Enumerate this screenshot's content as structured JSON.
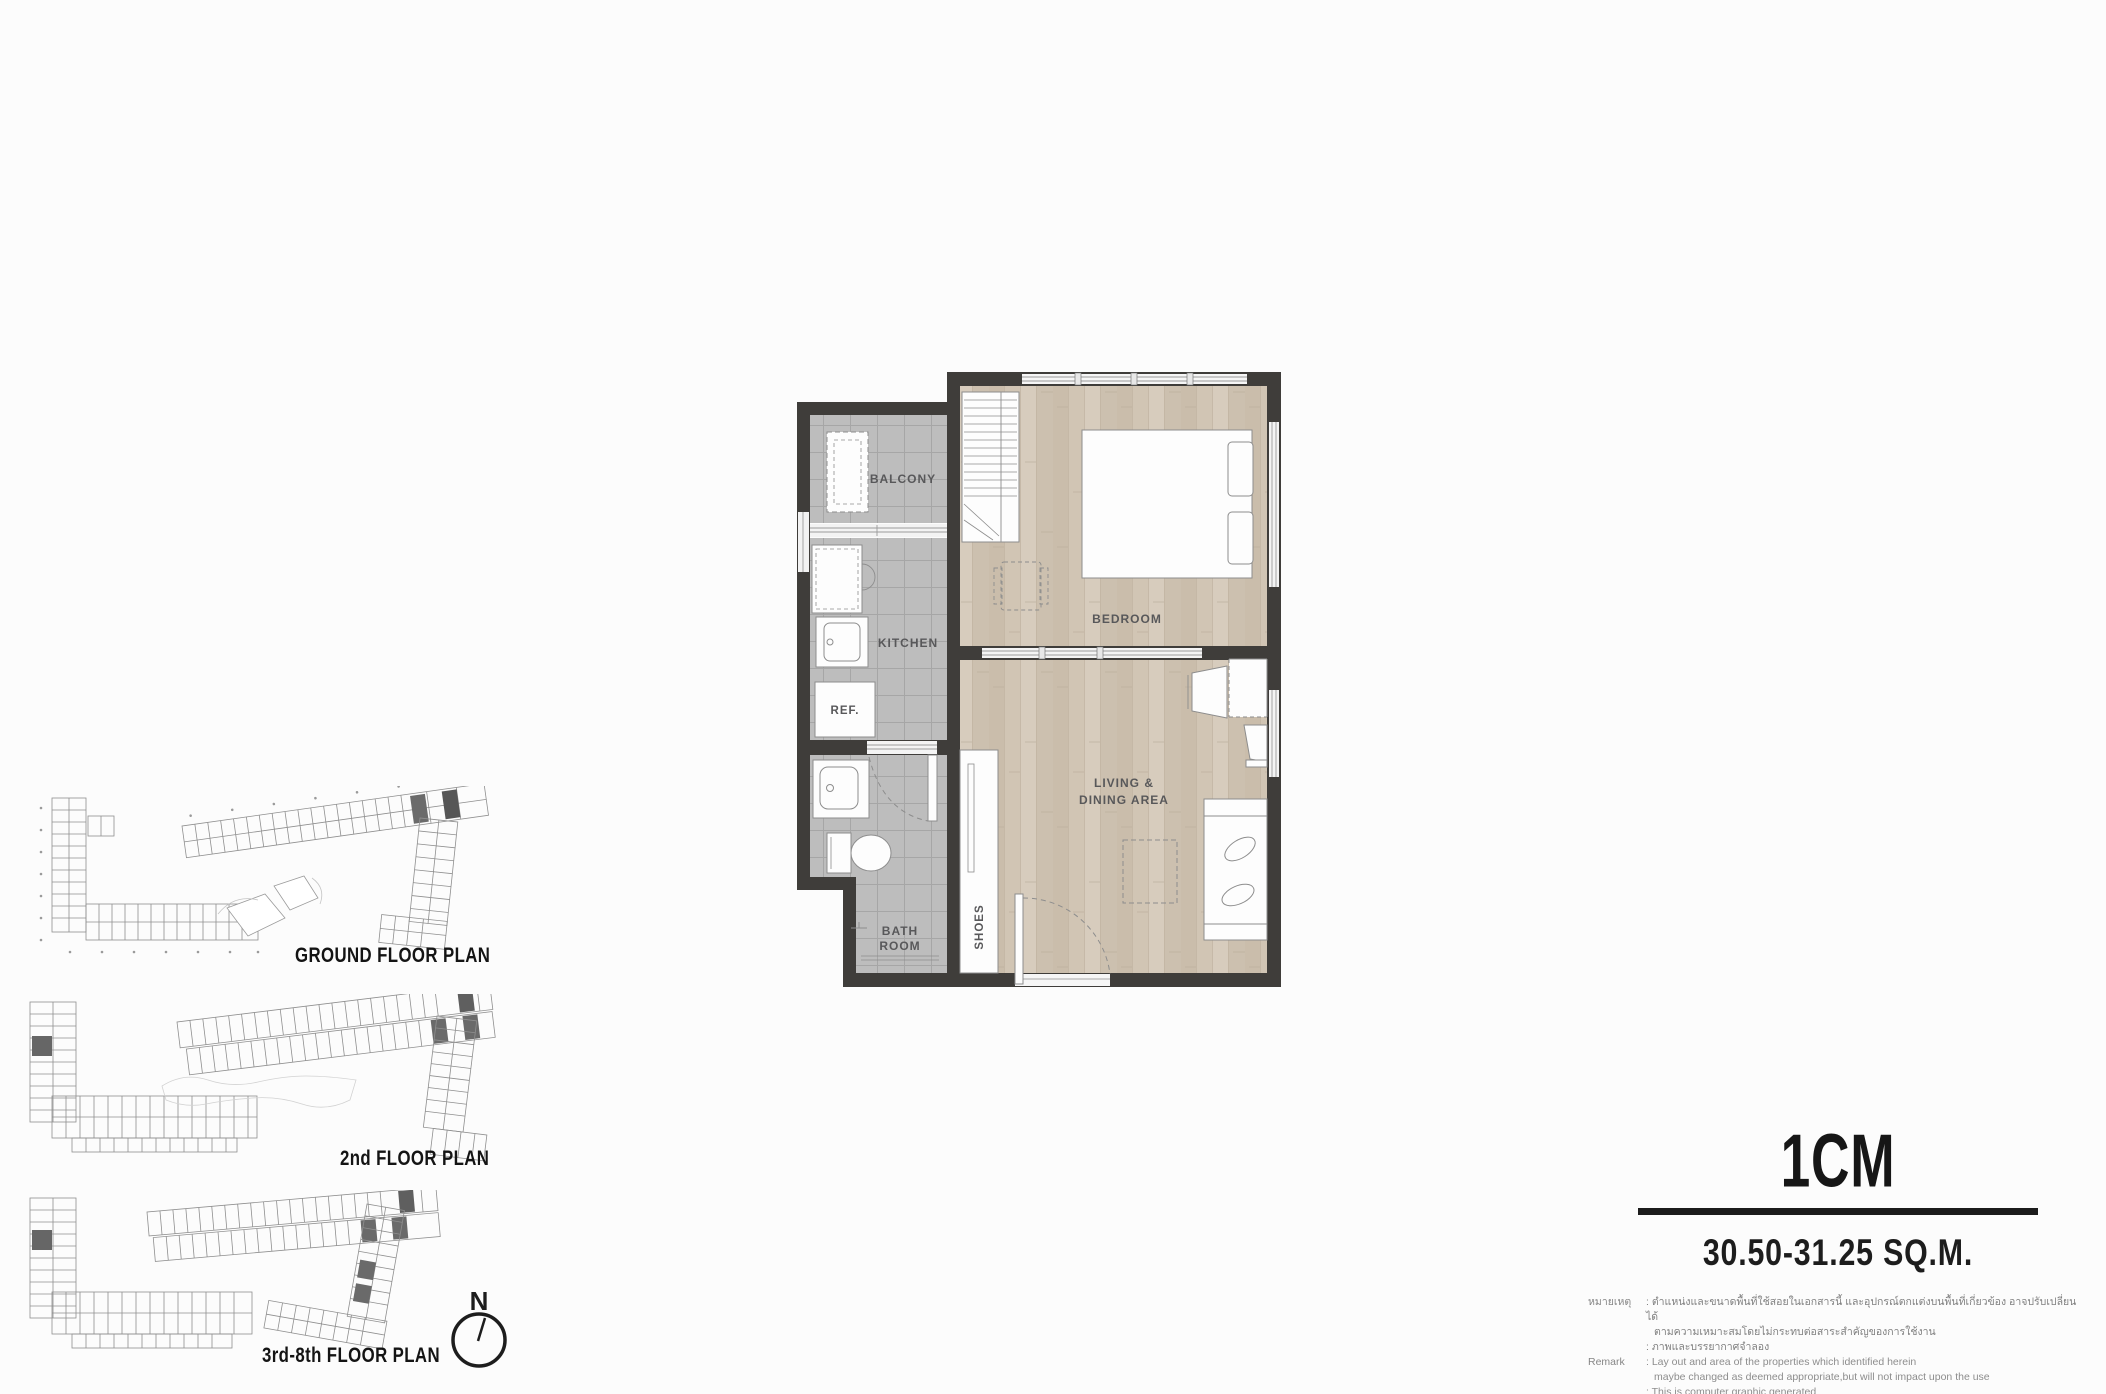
{
  "unit": {
    "code": "1CM",
    "area": "30.50-31.25  SQ.M."
  },
  "main_plan": {
    "labels": {
      "balcony": "BALCONY",
      "kitchen": "KITCHEN",
      "ref": "REF.",
      "bath_line1": "BATH",
      "bath_line2": "ROOM",
      "shoes": "SHOES",
      "bedroom": "BEDROOM",
      "living_line1": "LIVING &",
      "living_line2": "DINING AREA"
    }
  },
  "floor_plans": [
    {
      "label": "GROUND  FLOOR PLAN"
    },
    {
      "label": "2nd  FLOOR PLAN"
    },
    {
      "label": "3rd-8th  FLOOR PLAN"
    }
  ],
  "compass": {
    "label": "N"
  },
  "remarks": {
    "thai_label": "หมายเหตุ",
    "thai_line1": ": ตำแหน่งและขนาดพื้นที่ใช้สอยในเอกสารนี้ และอุปกรณ์ตกแต่งบนพื้นที่เกี่ยวข้อง อาจปรับเปลี่ยนได้",
    "thai_line2": "ตามความเหมาะสมโดยไม่กระทบต่อสาระสำคัญของการใช้งาน",
    "thai_line3": ": ภาพและบรรยากาศจำลอง",
    "en_label": "Remark",
    "en_line1": ": Lay out and area of the properties which identified herein",
    "en_line2": "maybe changed as deemed appropriate,but will not impact upon the use",
    "en_line3": ": This is computer graphic generated"
  },
  "colors": {
    "wall": "#3f3d3a",
    "tile_floor": "#bdbdbd",
    "wood_floor": "#d1c5b4",
    "furniture_outline": "#8d8d8d",
    "label_text": "#58585a",
    "heading_text": "#161616"
  }
}
